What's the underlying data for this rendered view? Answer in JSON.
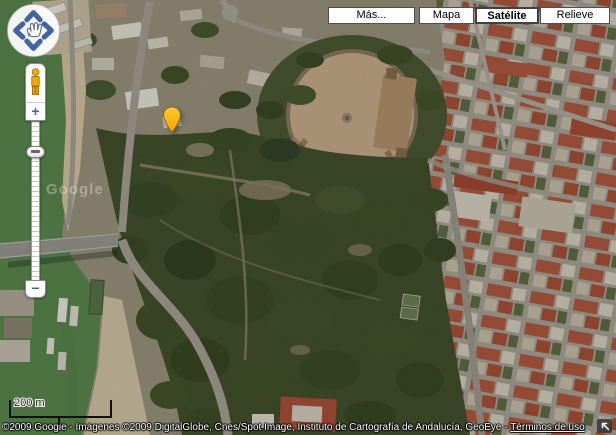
{
  "maptype_bar": {
    "more": {
      "label": "Más..."
    },
    "options": [
      {
        "label": "Mapa",
        "selected": false
      },
      {
        "label": "Satélite",
        "selected": true
      },
      {
        "label": "Relieve",
        "selected": false
      }
    ]
  },
  "nav_controls": {
    "pan": {
      "center_icon": "pan-hand",
      "arrows": [
        "up",
        "left",
        "right",
        "down"
      ]
    },
    "street_view_icon": "pegman",
    "zoom_in_label": "+",
    "zoom_out_label": "−"
  },
  "scale_bar": {
    "label": "200 m"
  },
  "watermark": {
    "text": "Google"
  },
  "attribution": {
    "text": "©2009 Google - Imágenes ©2009 DigitalGlobe, Cnes/Spot Image, Instituto de Cartografía de Andalucía, GeoEye - ",
    "terms_label": "Términos de uso"
  },
  "marker": {
    "color": "#FDB913"
  },
  "map": {
    "view": "satellite"
  },
  "colors": {
    "control_blue": "#44639F",
    "pegman_orange": "#F7A800",
    "water_green": "#5D8950",
    "park_green": "#45522E",
    "roof_terracotta": "#B25A40"
  }
}
